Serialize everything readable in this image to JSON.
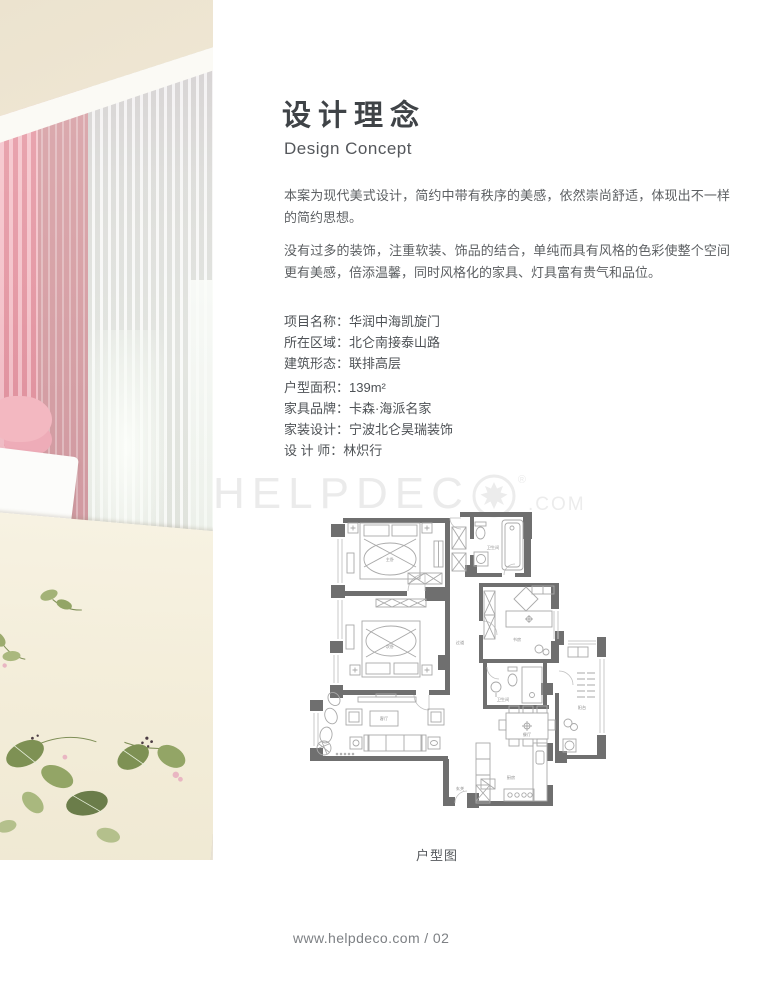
{
  "header": {
    "title": "设计理念",
    "subtitle": "Design Concept"
  },
  "intro": {
    "paragraph1": "本案为现代美式设计，简约中带有秩序的美感，依然崇尚舒适，体现出不一样的简约思想。",
    "paragraph2": "没有过多的装饰，注重软装、饰品的结合，单纯而具有风格的色彩使整个空间更有美感，倍添温馨，同时风格化的家具、灯具富有贵气和品位。"
  },
  "project_info": {
    "separator": "：",
    "rows": [
      {
        "label": "项目名称",
        "value": "华润中海凯旋门"
      },
      {
        "label": "所在区域",
        "value": "北仑南接泰山路"
      },
      {
        "label": "建筑形态",
        "value": "联排高层"
      },
      {
        "label": "户型面积",
        "value": "139m²"
      },
      {
        "label": "家具品牌",
        "value": "卡森·海派名家"
      },
      {
        "label": "家装设计",
        "value": "宁波北仑昊瑞装饰"
      },
      {
        "label": "设 计 师",
        "value": "林炽行"
      }
    ]
  },
  "watermark": {
    "letters": "HELPDEC",
    "registered": "®",
    "suffix": ".COM",
    "color": "#ebebeb"
  },
  "floorplan": {
    "caption": "户型图",
    "wall_color": "#6f6f6f",
    "labels": {
      "bed1": "主卧",
      "bed2": "次卧",
      "living": "客厅",
      "dining": "餐厅",
      "kitchen": "厨房",
      "study": "书房",
      "bath1": "卫生间",
      "bath2": "卫生间",
      "balcony": "阳台",
      "entry": "玄关",
      "hall": "过道"
    }
  },
  "footer": {
    "url_page": "www.helpdeco.com / 02"
  },
  "palette": {
    "curtain_pink": "#efaab4",
    "bedding_cream": "#f3edda",
    "leaf_green": "#87985c",
    "title_text": "#3f4347",
    "body_text": "#5d6063"
  }
}
